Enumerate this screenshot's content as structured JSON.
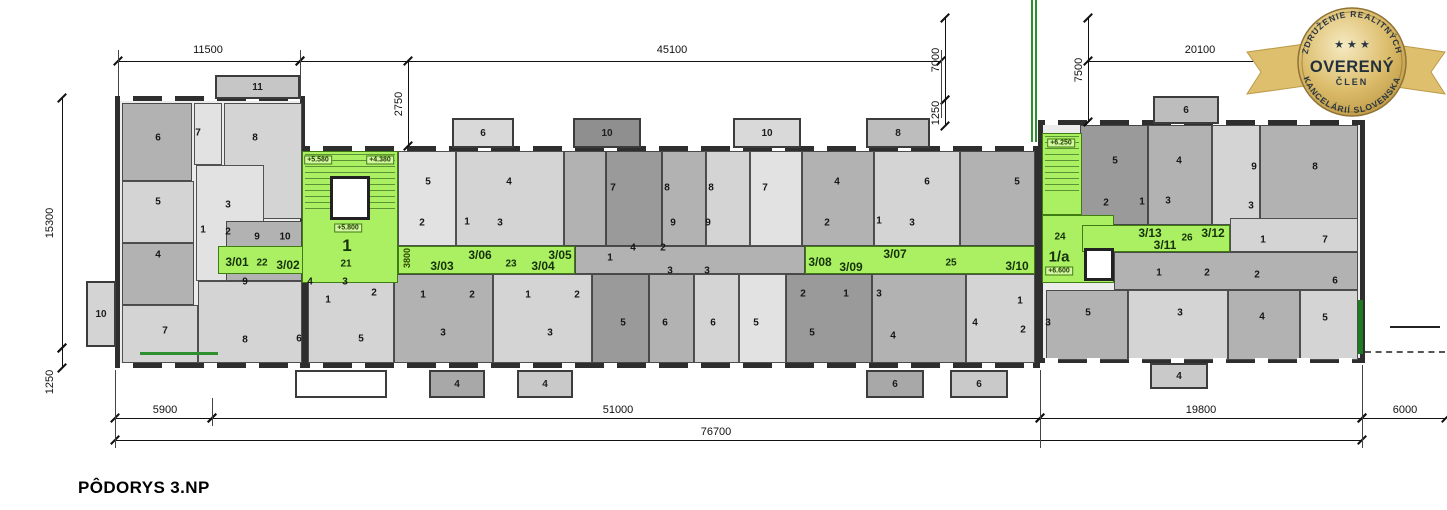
{
  "title": "PÔDORYS 3.NP",
  "badge": {
    "top_arc": "ZDRUŽENIE REALITNÝCH",
    "bottom_arc": "KANCELÁRIÍ SLOVENSKA",
    "main": "OVERENÝ",
    "sub": "ČLEN",
    "stars": "★ ★ ★"
  },
  "colors": {
    "green": "#abef62",
    "wall": "#2e2e2e",
    "shades": {
      "A": "#c6c6c6",
      "B": "#d4d4d4",
      "C": "#b2b2b2",
      "D": "#e2e2e2",
      "E": "#9a9a9a"
    }
  },
  "plan": {
    "blocks": [
      {
        "x": 115,
        "y": 96,
        "w": 190,
        "h": 272
      },
      {
        "x": 303,
        "y": 146,
        "w": 737,
        "h": 222
      },
      {
        "x": 1038,
        "y": 120,
        "w": 327,
        "h": 243
      }
    ],
    "tiles": [
      [
        "C",
        122,
        103,
        70,
        78
      ],
      [
        "D",
        194,
        103,
        28,
        62
      ],
      [
        "B",
        224,
        103,
        78,
        116
      ],
      [
        "B",
        122,
        181,
        72,
        62
      ],
      [
        "C",
        122,
        243,
        72,
        62
      ],
      [
        "B",
        122,
        305,
        76,
        58
      ],
      [
        "D",
        196,
        165,
        68,
        116
      ],
      [
        "C",
        226,
        221,
        76,
        60
      ],
      [
        "B",
        198,
        281,
        104,
        82
      ],
      [
        "D",
        398,
        151,
        58,
        95
      ],
      [
        "B",
        456,
        151,
        108,
        95
      ],
      [
        "C",
        564,
        151,
        42,
        95
      ],
      [
        "E",
        606,
        151,
        56,
        95
      ],
      [
        "C",
        662,
        151,
        44,
        95
      ],
      [
        "B",
        706,
        151,
        44,
        95
      ],
      [
        "D",
        750,
        151,
        52,
        95
      ],
      [
        "C",
        802,
        151,
        72,
        95
      ],
      [
        "B",
        874,
        151,
        86,
        95
      ],
      [
        "C",
        960,
        151,
        75,
        95
      ],
      [
        "C",
        575,
        246,
        230,
        28
      ],
      [
        "B",
        308,
        274,
        86,
        89
      ],
      [
        "C",
        394,
        274,
        99,
        89
      ],
      [
        "B",
        493,
        274,
        99,
        89
      ],
      [
        "E",
        592,
        274,
        57,
        89
      ],
      [
        "C",
        649,
        274,
        45,
        89
      ],
      [
        "B",
        694,
        274,
        45,
        89
      ],
      [
        "D",
        739,
        274,
        47,
        89
      ],
      [
        "E",
        786,
        274,
        86,
        89
      ],
      [
        "C",
        872,
        274,
        94,
        89
      ],
      [
        "B",
        966,
        274,
        69,
        89
      ],
      [
        "E",
        1080,
        125,
        68,
        100
      ],
      [
        "C",
        1148,
        125,
        64,
        100
      ],
      [
        "B",
        1212,
        125,
        48,
        100
      ],
      [
        "C",
        1260,
        125,
        98,
        100
      ],
      [
        "B",
        1230,
        218,
        128,
        34
      ],
      [
        "C",
        1114,
        252,
        244,
        38
      ],
      [
        "C",
        1046,
        290,
        82,
        70
      ],
      [
        "B",
        1128,
        290,
        100,
        70
      ],
      [
        "C",
        1228,
        290,
        72,
        70
      ],
      [
        "B",
        1300,
        290,
        58,
        70
      ]
    ],
    "greens": [
      {
        "x": 218,
        "y": 246,
        "w": 86,
        "h": 28
      },
      {
        "x": 302,
        "y": 151,
        "w": 96,
        "h": 132,
        "st": true
      },
      {
        "x": 398,
        "y": 246,
        "w": 177,
        "h": 28
      },
      {
        "x": 805,
        "y": 246,
        "w": 230,
        "h": 28
      },
      {
        "x": 1042,
        "y": 133,
        "w": 40,
        "h": 82,
        "st": true
      },
      {
        "x": 1042,
        "y": 215,
        "w": 72,
        "h": 68
      },
      {
        "x": 1082,
        "y": 225,
        "w": 148,
        "h": 27
      }
    ],
    "winstrips": [
      {
        "x": 120,
        "y": 96,
        "w": 180,
        "h": 5
      },
      {
        "x": 120,
        "y": 363,
        "w": 180,
        "h": 5
      },
      {
        "x": 310,
        "y": 146,
        "w": 723,
        "h": 5
      },
      {
        "x": 310,
        "y": 363,
        "w": 723,
        "h": 5
      },
      {
        "x": 1045,
        "y": 120,
        "w": 313,
        "h": 5
      },
      {
        "x": 1045,
        "y": 358,
        "w": 313,
        "h": 5
      }
    ],
    "balconies": [
      {
        "t": "11",
        "x": 215,
        "y": 75,
        "w": 85,
        "h": 24,
        "f": "#c6c6c6"
      },
      {
        "t": "6",
        "x": 452,
        "y": 118,
        "w": 62,
        "h": 30,
        "f": "#d9d9d9"
      },
      {
        "t": "10",
        "x": 573,
        "y": 118,
        "w": 68,
        "h": 30,
        "f": "#8f8f8f"
      },
      {
        "t": "10",
        "x": 733,
        "y": 118,
        "w": 68,
        "h": 30,
        "f": "#d9d9d9"
      },
      {
        "t": "8",
        "x": 866,
        "y": 118,
        "w": 64,
        "h": 30,
        "f": "#bdbdbd"
      },
      {
        "t": "6",
        "x": 1153,
        "y": 96,
        "w": 66,
        "h": 28,
        "f": "#bdbdbd"
      },
      {
        "t": "10",
        "x": 86,
        "y": 281,
        "w": 30,
        "h": 66,
        "f": "#d4d4d4"
      },
      {
        "t": "",
        "x": 295,
        "y": 370,
        "w": 92,
        "h": 28,
        "f": "#ffffff"
      },
      {
        "t": "4",
        "x": 429,
        "y": 370,
        "w": 56,
        "h": 28,
        "f": "#a8a8a8"
      },
      {
        "t": "4",
        "x": 517,
        "y": 370,
        "w": 56,
        "h": 28,
        "f": "#c9c9c9"
      },
      {
        "t": "6",
        "x": 866,
        "y": 370,
        "w": 58,
        "h": 28,
        "f": "#a8a8a8"
      },
      {
        "t": "6",
        "x": 950,
        "y": 370,
        "w": 58,
        "h": 28,
        "f": "#c9c9c9"
      },
      {
        "t": "4",
        "x": 1150,
        "y": 363,
        "w": 58,
        "h": 26,
        "f": "#c9c9c9"
      }
    ],
    "elevators": [
      {
        "x": 330,
        "y": 176,
        "w": 40,
        "h": 44
      },
      {
        "x": 1084,
        "y": 248,
        "w": 30,
        "h": 33
      }
    ],
    "accents": [
      {
        "x": 1031,
        "y": 0,
        "w": 2,
        "h": 142,
        "c": "#2d8f2d"
      },
      {
        "x": 1035,
        "y": 0,
        "w": 2,
        "h": 142,
        "c": "#2d8f2d"
      },
      {
        "x": 140,
        "y": 352,
        "w": 78,
        "h": 3,
        "c": "#2d8f2d"
      },
      {
        "x": 1358,
        "y": 300,
        "w": 5,
        "h": 54,
        "c": "#1f7a1f"
      },
      {
        "x": 1390,
        "y": 326,
        "w": 50,
        "h": 2,
        "c": "#222222"
      },
      {
        "x": 1365,
        "y": 351,
        "w": 80,
        "h": 0,
        "c": "#555555",
        "dashed": true
      }
    ],
    "rooms": [
      [
        "6",
        158,
        138
      ],
      [
        "7",
        198,
        133
      ],
      [
        "8",
        255,
        138
      ],
      [
        "5",
        158,
        202
      ],
      [
        "3",
        228,
        205
      ],
      [
        "1",
        203,
        230
      ],
      [
        "2",
        228,
        232
      ],
      [
        "9",
        257,
        237
      ],
      [
        "10",
        285,
        237
      ],
      [
        "4",
        158,
        255
      ],
      [
        "7",
        165,
        331
      ],
      [
        "9",
        245,
        282
      ],
      [
        "8",
        245,
        340
      ],
      [
        "5",
        428,
        182
      ],
      [
        "4",
        509,
        182
      ],
      [
        "2",
        422,
        223
      ],
      [
        "1",
        467,
        222
      ],
      [
        "3",
        500,
        223
      ],
      [
        "7",
        613,
        188
      ],
      [
        "8",
        667,
        188
      ],
      [
        "8",
        711,
        188
      ],
      [
        "7",
        765,
        188
      ],
      [
        "9",
        673,
        223
      ],
      [
        "9",
        708,
        223
      ],
      [
        "4",
        837,
        182
      ],
      [
        "6",
        927,
        182
      ],
      [
        "2",
        827,
        223
      ],
      [
        "1",
        879,
        221
      ],
      [
        "3",
        912,
        223
      ],
      [
        "5",
        1017,
        182
      ],
      [
        "1",
        610,
        258
      ],
      [
        "4",
        633,
        248
      ],
      [
        "2",
        663,
        248
      ],
      [
        "3",
        670,
        271
      ],
      [
        "3",
        707,
        271
      ],
      [
        "4",
        310,
        282
      ],
      [
        "1",
        328,
        300
      ],
      [
        "3",
        345,
        282
      ],
      [
        "2",
        374,
        293
      ],
      [
        "1",
        423,
        295
      ],
      [
        "2",
        472,
        295
      ],
      [
        "1",
        528,
        295
      ],
      [
        "2",
        577,
        295
      ],
      [
        "2",
        803,
        294
      ],
      [
        "1",
        846,
        294
      ],
      [
        "3",
        879,
        294
      ],
      [
        "6",
        299,
        339
      ],
      [
        "5",
        361,
        339
      ],
      [
        "3",
        443,
        333
      ],
      [
        "3",
        550,
        333
      ],
      [
        "5",
        623,
        323
      ],
      [
        "6",
        665,
        323
      ],
      [
        "6",
        713,
        323
      ],
      [
        "5",
        756,
        323
      ],
      [
        "5",
        812,
        333
      ],
      [
        "4",
        893,
        336
      ],
      [
        "4",
        975,
        323
      ],
      [
        "1",
        1020,
        301
      ],
      [
        "2",
        1023,
        330
      ],
      [
        "5",
        1115,
        161
      ],
      [
        "4",
        1179,
        161
      ],
      [
        "9",
        1254,
        167
      ],
      [
        "8",
        1315,
        167
      ],
      [
        "2",
        1106,
        203
      ],
      [
        "1",
        1142,
        202
      ],
      [
        "3",
        1168,
        201
      ],
      [
        "3",
        1251,
        206
      ],
      [
        "1",
        1263,
        240
      ],
      [
        "7",
        1325,
        240
      ],
      [
        "1",
        1159,
        273
      ],
      [
        "2",
        1207,
        273
      ],
      [
        "2",
        1257,
        275
      ],
      [
        "6",
        1335,
        281
      ],
      [
        "5",
        1088,
        313
      ],
      [
        "3",
        1180,
        313
      ],
      [
        "4",
        1262,
        317
      ],
      [
        "5",
        1325,
        318
      ],
      [
        "3",
        1048,
        323
      ]
    ],
    "units": [
      {
        "t": "3/01",
        "x": 237,
        "y": 262
      },
      {
        "t": "22",
        "x": 262,
        "y": 263,
        "fs": 10
      },
      {
        "t": "3/02",
        "x": 288,
        "y": 265
      },
      {
        "t": "1",
        "x": 347,
        "y": 246,
        "fs": 17
      },
      {
        "t": "21",
        "x": 346,
        "y": 264,
        "fs": 10
      },
      {
        "t": "3/03",
        "x": 442,
        "y": 266
      },
      {
        "t": "3/06",
        "x": 480,
        "y": 255
      },
      {
        "t": "23",
        "x": 511,
        "y": 264,
        "fs": 10
      },
      {
        "t": "3/05",
        "x": 560,
        "y": 255
      },
      {
        "t": "3/04",
        "x": 543,
        "y": 266
      },
      {
        "t": "3/08",
        "x": 820,
        "y": 262
      },
      {
        "t": "3/09",
        "x": 851,
        "y": 267
      },
      {
        "t": "3/07",
        "x": 895,
        "y": 254
      },
      {
        "t": "25",
        "x": 951,
        "y": 263,
        "fs": 10
      },
      {
        "t": "3/10",
        "x": 1017,
        "y": 266
      },
      {
        "t": "24",
        "x": 1060,
        "y": 237,
        "fs": 10
      },
      {
        "t": "1/a",
        "x": 1059,
        "y": 257,
        "fs": 15
      },
      {
        "t": "3/13",
        "x": 1150,
        "y": 233
      },
      {
        "t": "3/11",
        "x": 1165,
        "y": 245
      },
      {
        "t": "26",
        "x": 1187,
        "y": 238,
        "fs": 10
      },
      {
        "t": "3/12",
        "x": 1213,
        "y": 233
      }
    ],
    "tags": [
      [
        "+5.580",
        318,
        160
      ],
      [
        "+4.380",
        380,
        160
      ],
      [
        "+5.800",
        348,
        228
      ],
      [
        "+6.250",
        1061,
        143
      ],
      [
        "+6.600",
        1059,
        271
      ]
    ],
    "vlabel": {
      "t": "3800",
      "x": 407,
      "y": 258
    }
  },
  "dimensions": {
    "h": [
      [
        118,
        300,
        61,
        "11500",
        208,
        50
      ],
      [
        300,
        941,
        61,
        "45100",
        672,
        50
      ],
      [
        1088,
        1365,
        61,
        "20100",
        1200,
        50
      ],
      [
        115,
        212,
        418,
        "5900",
        165,
        410
      ],
      [
        212,
        1040,
        418,
        "51000",
        618,
        410
      ],
      [
        1040,
        1362,
        418,
        "19800",
        1201,
        410
      ],
      [
        1362,
        1446,
        418,
        "6000",
        1405,
        410
      ],
      [
        115,
        1362,
        440,
        "76700",
        716,
        432
      ]
    ],
    "v": [
      [
        62,
        98,
        348,
        "15300",
        50,
        223
      ],
      [
        62,
        348,
        368,
        "1250",
        50,
        382
      ],
      [
        408,
        61,
        146,
        "2750",
        399,
        104
      ],
      [
        945,
        18,
        100,
        "7000",
        936,
        60
      ],
      [
        945,
        100,
        126,
        "1250",
        936,
        113
      ],
      [
        1088,
        18,
        122,
        "7500",
        1079,
        70
      ]
    ],
    "ext": [
      [
        118,
        50,
        96
      ],
      [
        300,
        50,
        100
      ],
      [
        941,
        50,
        118
      ],
      [
        1365,
        50,
        112
      ],
      [
        115,
        370,
        448
      ],
      [
        212,
        398,
        426
      ],
      [
        1040,
        370,
        448
      ],
      [
        1362,
        365,
        448
      ]
    ]
  }
}
